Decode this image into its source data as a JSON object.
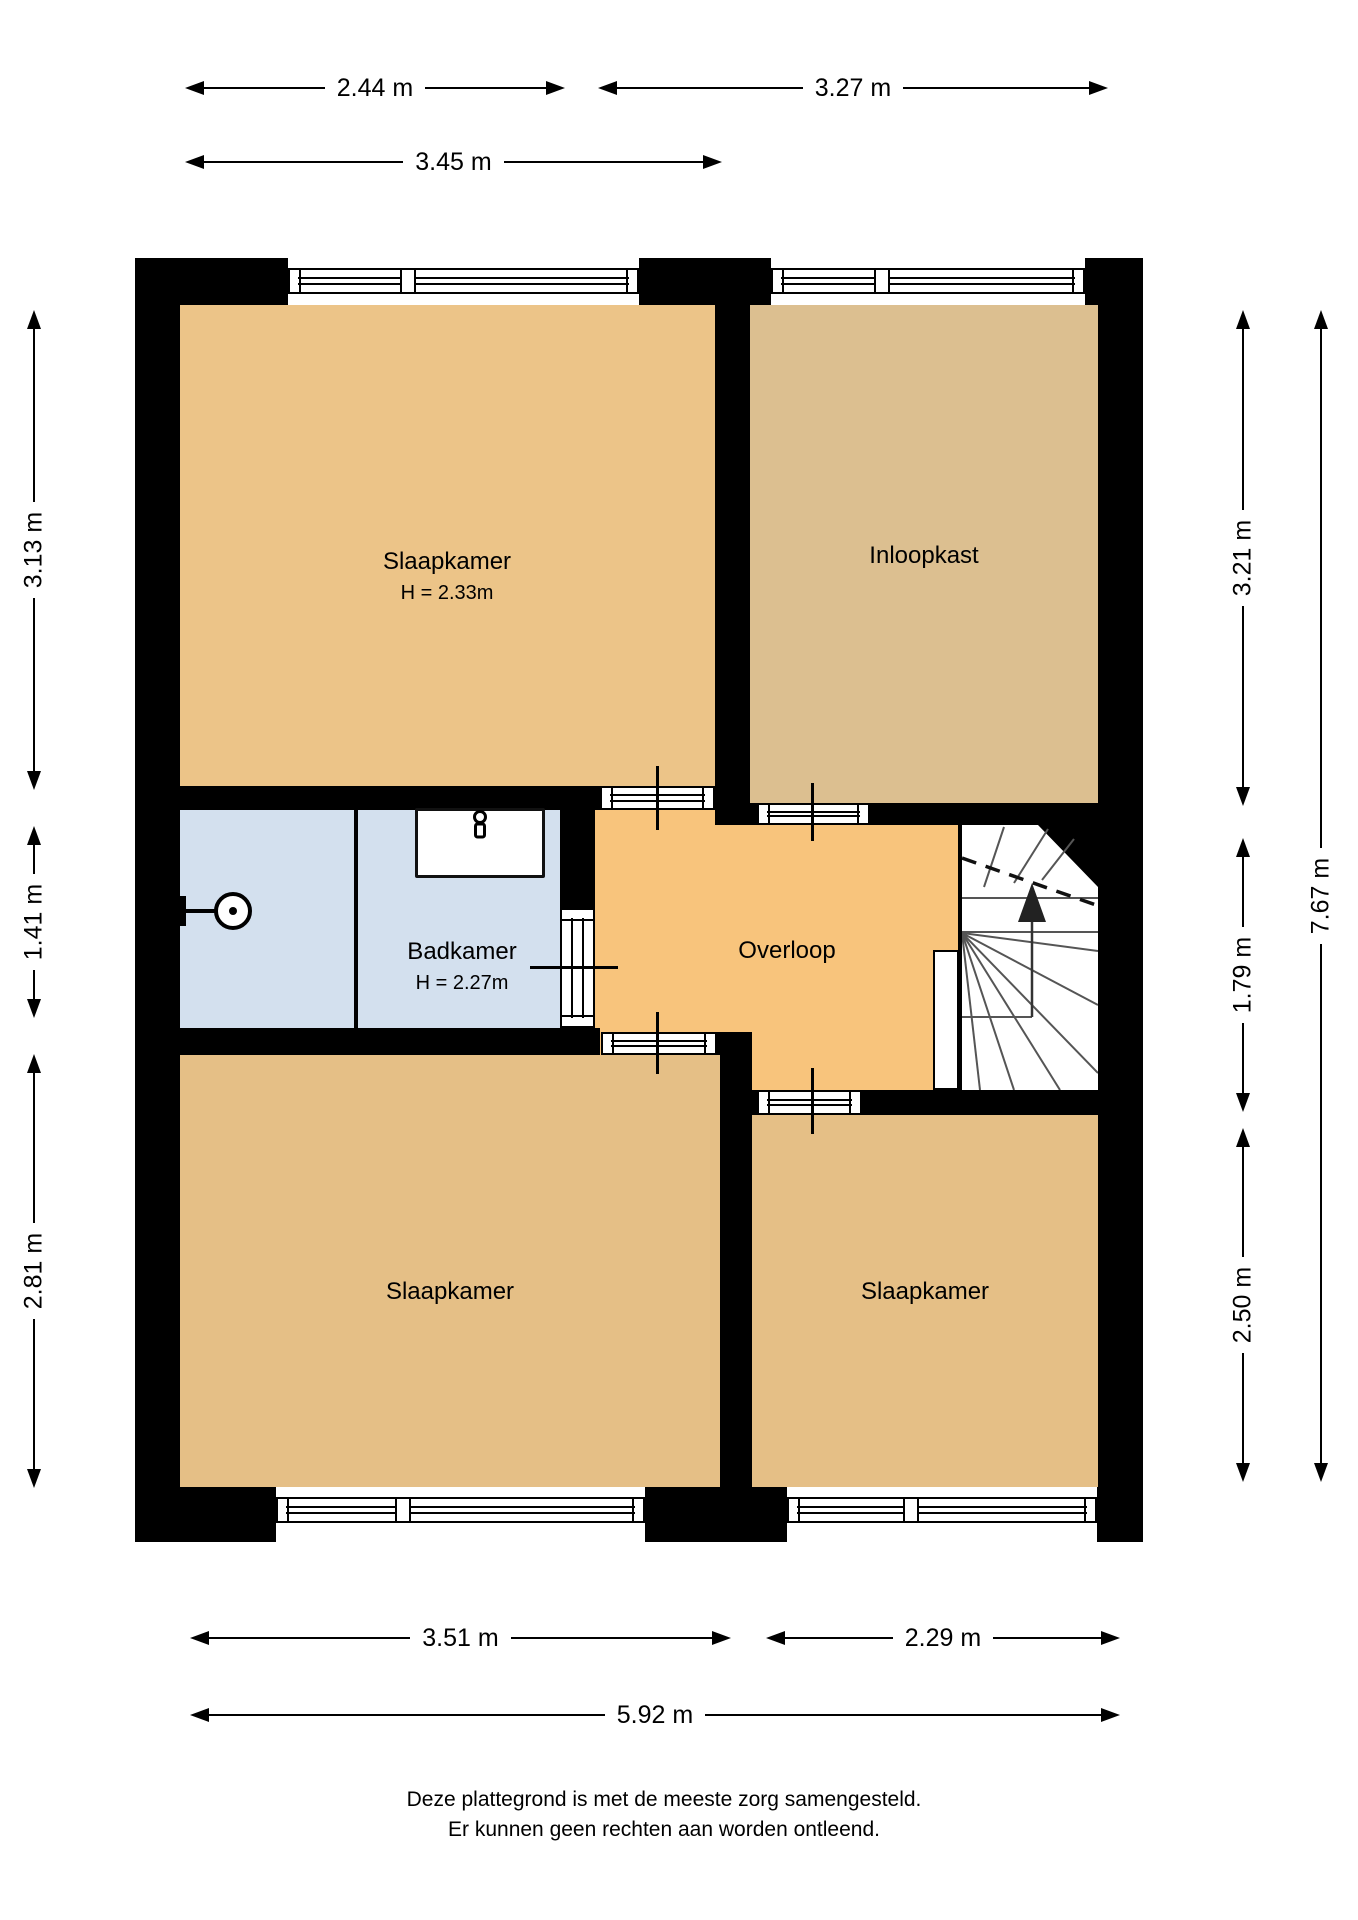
{
  "page": {
    "background": "#ffffff",
    "wall_color": "#000000"
  },
  "footer": {
    "line1": "Deze plattegrond is met de meeste zorg samengesteld.",
    "line2": "Er kunnen geen rechten aan worden ontleend."
  },
  "plan": {
    "rooms": [
      {
        "name": "room-slaapkamer-tl",
        "label": "Slaapkamer",
        "sublabel": "H = 2.33m",
        "x": 180,
        "y": 305,
        "w": 535,
        "h": 481,
        "color": "#ecc488",
        "cx": 447,
        "cy": 576
      },
      {
        "name": "room-inloopkast",
        "label": "Inloopkast",
        "sublabel": "",
        "x": 750,
        "y": 305,
        "w": 348,
        "h": 498,
        "color": "#dcbf90",
        "cx": 924,
        "cy": 556
      },
      {
        "name": "room-badkamer",
        "label": "Badkamer",
        "sublabel": "H = 2.27m",
        "x": 180,
        "y": 810,
        "w": 380,
        "h": 218,
        "color": "#d3e0ee",
        "cx": 462,
        "cy": 966
      },
      {
        "name": "room-overloop",
        "label": "Overloop",
        "sublabel": "",
        "x": 595,
        "y": 810,
        "w": 363,
        "h": 280,
        "color": "#f8c47c",
        "cx": 787,
        "cy": 951
      },
      {
        "name": "room-slaapkamer-bl",
        "label": "Slaapkamer",
        "sublabel": "",
        "x": 180,
        "y": 1055,
        "w": 540,
        "h": 432,
        "color": "#e5bf86",
        "cx": 450,
        "cy": 1292
      },
      {
        "name": "room-slaapkamer-br",
        "label": "Slaapkamer",
        "sublabel": "",
        "x": 752,
        "y": 1115,
        "w": 346,
        "h": 372,
        "color": "#e5bf86",
        "cx": 925,
        "cy": 1292
      }
    ],
    "walls": [
      {
        "name": "wall-left",
        "x": 135,
        "y": 258,
        "w": 45,
        "h": 1274
      },
      {
        "name": "wall-right",
        "x": 1098,
        "y": 258,
        "w": 45,
        "h": 1274
      },
      {
        "name": "wall-top-corner-left",
        "x": 135,
        "y": 258,
        "w": 153,
        "h": 47
      },
      {
        "name": "wall-top-pier",
        "x": 639,
        "y": 258,
        "w": 132,
        "h": 47
      },
      {
        "name": "wall-top-corner-right",
        "x": 1085,
        "y": 258,
        "w": 58,
        "h": 47
      },
      {
        "name": "wall-bottom-corner-left",
        "x": 135,
        "y": 1487,
        "w": 141,
        "h": 55
      },
      {
        "name": "wall-bottom-pier",
        "x": 645,
        "y": 1487,
        "w": 142,
        "h": 55
      },
      {
        "name": "wall-bottom-corner-right",
        "x": 1097,
        "y": 1487,
        "w": 46,
        "h": 55
      },
      {
        "name": "wall-tl-bottom",
        "x": 180,
        "y": 786,
        "w": 420,
        "h": 24
      },
      {
        "name": "wall-mid-vertical",
        "x": 715,
        "y": 305,
        "w": 35,
        "h": 520
      },
      {
        "name": "wall-inloopkast-bottom-stub",
        "x": 750,
        "y": 803,
        "w": 10,
        "h": 22
      },
      {
        "name": "wall-inloopkast-bottom",
        "x": 870,
        "y": 803,
        "w": 228,
        "h": 22
      },
      {
        "name": "wall-badkamer-right-top",
        "x": 560,
        "y": 810,
        "w": 35,
        "h": 98
      },
      {
        "name": "wall-badkamer-right-bottom",
        "x": 560,
        "y": 1028,
        "w": 35,
        "h": 27
      },
      {
        "name": "wall-badkamer-bottom",
        "x": 180,
        "y": 1028,
        "w": 420,
        "h": 27
      },
      {
        "name": "wall-shower-divider",
        "x": 354,
        "y": 810,
        "w": 4,
        "h": 218
      },
      {
        "name": "wall-corner-bl",
        "x": 717,
        "y": 1032,
        "w": 35,
        "h": 23
      },
      {
        "name": "wall-bottom-vertical",
        "x": 720,
        "y": 1055,
        "w": 32,
        "h": 432
      },
      {
        "name": "wall-overloop-br-stub",
        "x": 752,
        "y": 1090,
        "w": 5,
        "h": 25
      },
      {
        "name": "wall-overloop-br",
        "x": 862,
        "y": 1090,
        "w": 236,
        "h": 25
      },
      {
        "name": "wall-stairs-edge",
        "x": 958,
        "y": 825,
        "w": 4,
        "h": 268
      }
    ],
    "openings": [
      {
        "name": "window-top-left",
        "type": "window",
        "x": 288,
        "y": 268,
        "w": 351,
        "h": 26,
        "o": "h",
        "divider": 118
      },
      {
        "name": "window-top-right",
        "type": "window",
        "x": 771,
        "y": 268,
        "w": 314,
        "h": 26,
        "o": "h",
        "divider": 109
      },
      {
        "name": "window-bottom-left",
        "type": "window",
        "x": 276,
        "y": 1497,
        "w": 369,
        "h": 26,
        "o": "h",
        "divider": 125
      },
      {
        "name": "door-slaapkamer-tl",
        "type": "door",
        "x": 600,
        "y": 786,
        "w": 115,
        "h": 24,
        "o": "h",
        "divider": null
      },
      {
        "name": "window-bottom-right",
        "type": "window",
        "x": 787,
        "y": 1497,
        "w": 310,
        "h": 26,
        "o": "h",
        "divider": 122
      },
      {
        "name": "door-inloopkast",
        "type": "door",
        "x": 757,
        "y": 803,
        "w": 113,
        "h": 22,
        "o": "h",
        "divider": null
      },
      {
        "name": "door-badkamer",
        "type": "door",
        "x": 560,
        "y": 908,
        "w": 35,
        "h": 120,
        "o": "v",
        "divider": null
      },
      {
        "name": "door-slaapkamer-bl",
        "type": "door",
        "x": 601,
        "y": 1032,
        "w": 116,
        "h": 23,
        "o": "h",
        "divider": null
      },
      {
        "name": "door-slaapkamer-br",
        "type": "door",
        "x": 757,
        "y": 1090,
        "w": 105,
        "h": 25,
        "o": "h",
        "divider": null
      }
    ],
    "ticks": [
      {
        "name": "door-tick",
        "x": 656,
        "y": 766,
        "w": 3,
        "h": 64
      },
      {
        "name": "door-tick",
        "x": 811,
        "y": 783,
        "w": 3,
        "h": 58
      },
      {
        "name": "door-tick",
        "x": 530,
        "y": 966,
        "w": 88,
        "h": 3
      },
      {
        "name": "door-tick",
        "x": 656,
        "y": 1012,
        "w": 3,
        "h": 62
      },
      {
        "name": "door-tick",
        "x": 811,
        "y": 1068,
        "w": 3,
        "h": 66
      }
    ]
  },
  "dimensions": [
    {
      "name": "dim-window-2-44",
      "label": "2.44 m",
      "orient": "h",
      "x1": 185,
      "x2": 565,
      "y": 88
    },
    {
      "name": "dim-window-3-27",
      "label": "3.27 m",
      "orient": "h",
      "x1": 598,
      "x2": 1108,
      "y": 88
    },
    {
      "name": "dim-room-3-45",
      "label": "3.45 m",
      "orient": "h",
      "x1": 185,
      "x2": 722,
      "y": 162
    },
    {
      "name": "dim-room-3-51",
      "label": "3.51 m",
      "orient": "h",
      "x1": 190,
      "x2": 731,
      "y": 1638
    },
    {
      "name": "dim-room-2-29",
      "label": "2.29 m",
      "orient": "h",
      "x1": 766,
      "x2": 1120,
      "y": 1638
    },
    {
      "name": "dim-total-5-92",
      "label": "5.92 m",
      "orient": "h",
      "x1": 190,
      "x2": 1120,
      "y": 1715
    },
    {
      "name": "dim-left-3-13",
      "label": "3.13 m",
      "orient": "v",
      "x": 34,
      "y1": 310,
      "y2": 790
    },
    {
      "name": "dim-left-1-41",
      "label": "1.41 m",
      "orient": "v",
      "x": 34,
      "y1": 826,
      "y2": 1018
    },
    {
      "name": "dim-left-2-81",
      "label": "2.81 m",
      "orient": "v",
      "x": 34,
      "y1": 1054,
      "y2": 1488
    },
    {
      "name": "dim-right-3-21",
      "label": "3.21 m",
      "orient": "v",
      "x": 1243,
      "y1": 310,
      "y2": 806
    },
    {
      "name": "dim-right-1-79",
      "label": "1.79 m",
      "orient": "v",
      "x": 1243,
      "y1": 838,
      "y2": 1112
    },
    {
      "name": "dim-right-2-50",
      "label": "2.50 m",
      "orient": "v",
      "x": 1243,
      "y1": 1128,
      "y2": 1482
    },
    {
      "name": "dim-total-7-67",
      "label": "7.67 m",
      "orient": "v",
      "x": 1321,
      "y1": 310,
      "y2": 1482
    }
  ]
}
